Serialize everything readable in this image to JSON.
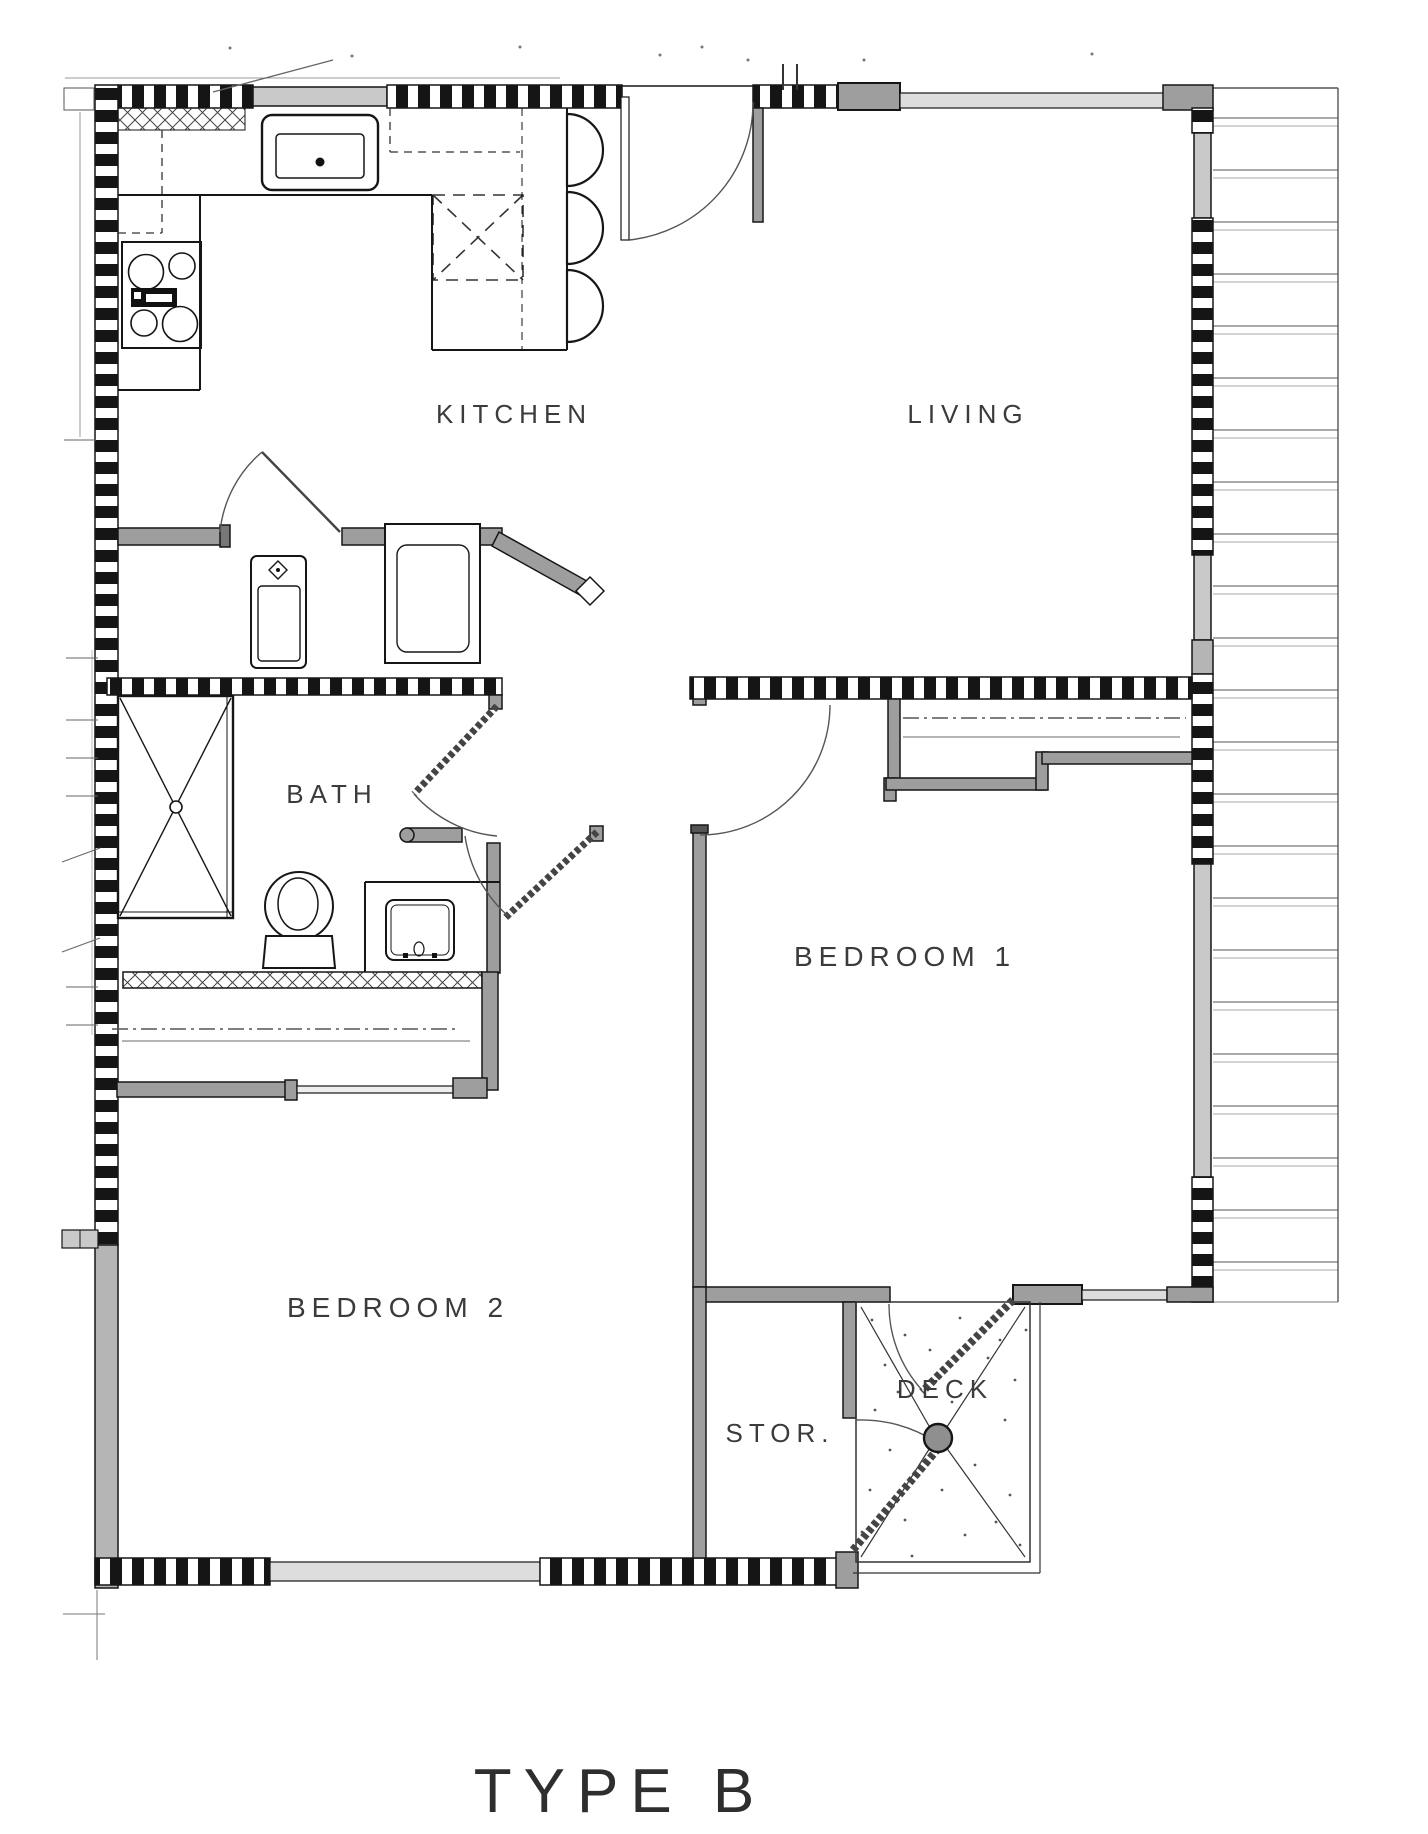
{
  "document": {
    "type": "architectural-floor-plan",
    "title": "TYPE B"
  },
  "rooms": [
    {
      "name": "kitchen",
      "label": "KITCHEN"
    },
    {
      "name": "living",
      "label": "LIVING"
    },
    {
      "name": "bath",
      "label": "BATH"
    },
    {
      "name": "bedroom1",
      "label": "BEDROOM 1"
    },
    {
      "name": "bedroom2",
      "label": "BEDROOM 2"
    },
    {
      "name": "storage",
      "label": "STOR."
    },
    {
      "name": "deck",
      "label": "DECK"
    }
  ],
  "colors": {
    "background": "#ffffff",
    "wall_fill": "#9e9e9e",
    "wall_line": "#161616",
    "window_fill": "#c9c9c9",
    "label_text": "#3b3b3b",
    "swing_line": "#555555"
  },
  "fixtures": [
    "kitchen-sink",
    "range-cooktop",
    "island-counter",
    "bar-stools",
    "upper-cabinets-dashed",
    "refrigerator-dashed",
    "utility-sink",
    "washer",
    "shower",
    "toilet",
    "vanity-sink",
    "closet-rod-bedroom1",
    "closet-rod-bedroom2",
    "deck-post"
  ]
}
